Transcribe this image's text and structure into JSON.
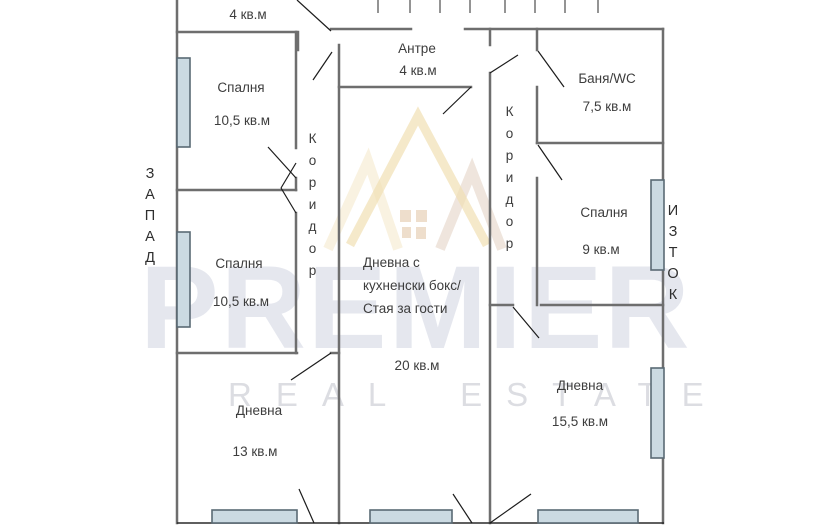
{
  "plan": {
    "compass": {
      "west": "ЗАПАД",
      "east": "ИЗТОК"
    },
    "corridor_left": "Коридор",
    "corridor_right": "Коридор",
    "rooms": {
      "storage": {
        "area": "4 кв.м"
      },
      "bedroom1": {
        "name": "Спалня",
        "area": "10,5 кв.м"
      },
      "entry": {
        "name": "Антре",
        "area": "4 кв.м"
      },
      "bath": {
        "name": "Баня/WC",
        "area": "7,5 кв.м"
      },
      "bedroom2": {
        "name": "Спалня",
        "area": "10,5 кв.м"
      },
      "bedroom3": {
        "name": "Спалня",
        "area": "9 кв.м"
      },
      "living_main": {
        "line1": "Дневна с",
        "line2": "кухненски бокс/",
        "line3": "Стая за гости",
        "area": "20 кв.м"
      },
      "living2": {
        "name": "Дневна",
        "area": "13 кв.м"
      },
      "living3": {
        "name": "Дневна",
        "area": "15,5 кв.м"
      }
    },
    "watermark": {
      "brand": "PREMIER",
      "tagline": "REAL ESTATE"
    },
    "colors": {
      "wall": "#6e6e6e",
      "thin_line": "#222222",
      "window_fill": "#cbdae2",
      "window_border": "#5a6a74",
      "label_text": "#3d3d3d",
      "watermark_text": "#ccd0df",
      "watermark_gold": "#f1dfb4"
    }
  }
}
